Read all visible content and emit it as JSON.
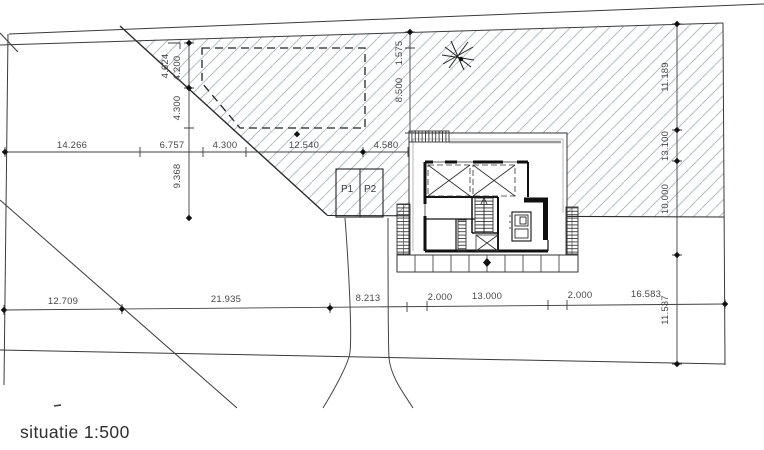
{
  "drawing": {
    "title": "situatie 1:500"
  },
  "parking": {
    "p1": "P1",
    "p2": "P2"
  },
  "dimensions": {
    "middle_row": [
      "14.266",
      "6.757",
      "4.300",
      "12.540",
      "4.580"
    ],
    "left_column": [
      "4.624",
      "4.200",
      "4.300",
      "9.368"
    ],
    "center_column": [
      "1.575",
      "8.500"
    ],
    "right_column": [
      "11.189",
      "13.100",
      "10.000",
      "11.537"
    ],
    "bottom_row": [
      "12.709",
      "21.935",
      "8.213",
      "2.000",
      "13.000",
      "2.000",
      "16.583"
    ]
  },
  "symbols": {
    "tree": "deciduous-tree-icon"
  },
  "colors": {
    "line": "#3a3a3a",
    "hatch": "#b4bec5",
    "dim_text": "#474747",
    "wall": "#101010"
  }
}
